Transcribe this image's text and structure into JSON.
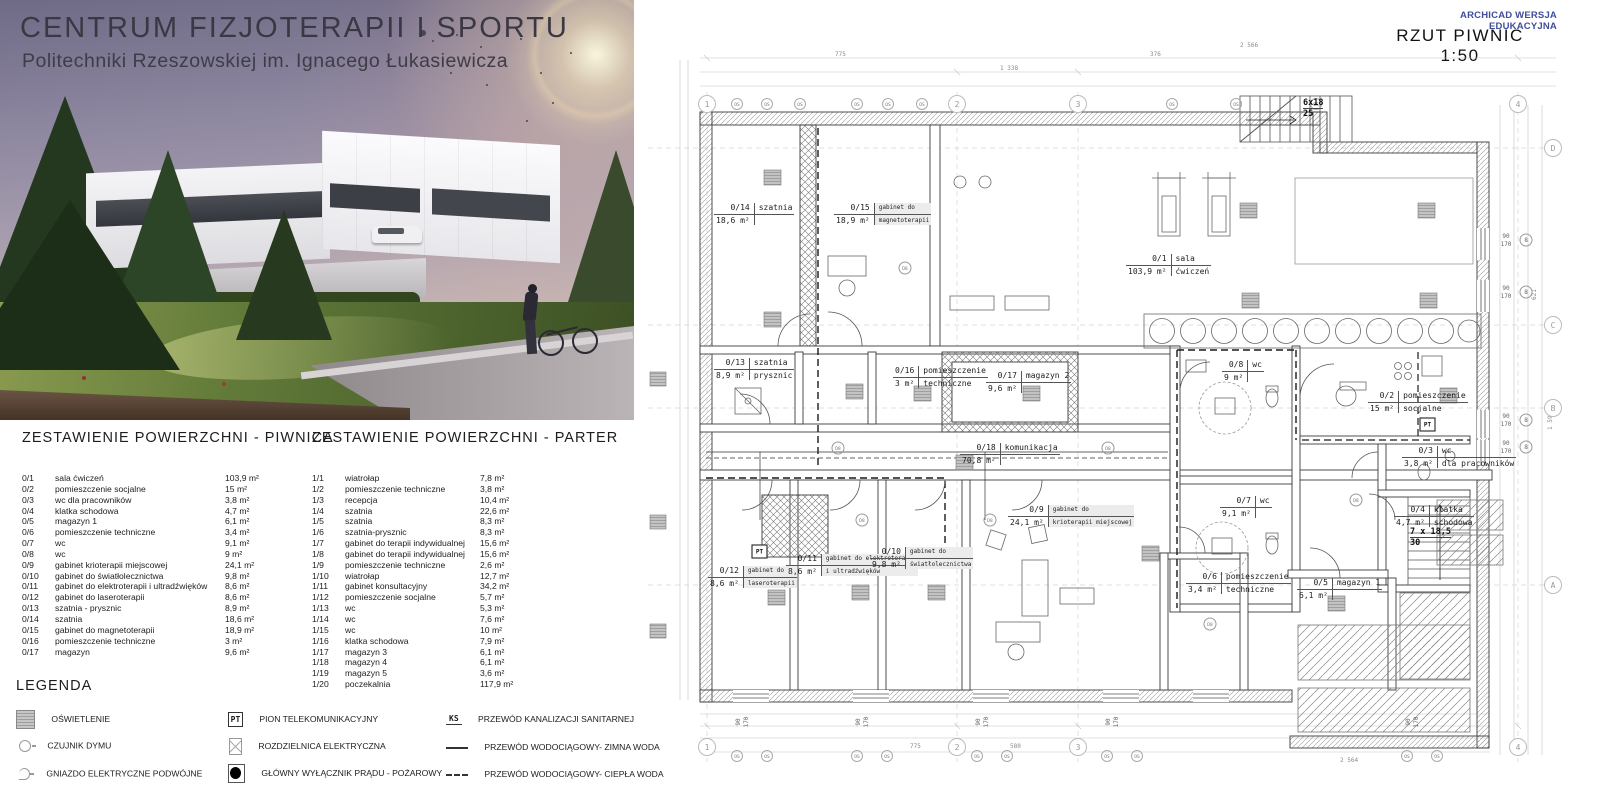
{
  "hero": {
    "title": "CENTRUM  FIZJOTERAPII I SPORTU",
    "subtitle": "Politechniki Rzeszowskiej im. Ignacego Łukasiewicza"
  },
  "plan_header": {
    "watermark": "ARCHICAD WERSJA EDUKACYJNA",
    "title": "RZUT PIWNIC 1:50"
  },
  "tables": [
    {
      "title": "ZESTAWIENIE POWIERZCHNI - PIWNICA",
      "rows": [
        {
          "id": "0/1",
          "name": "sala ćwiczeń",
          "area": "103,9 m²"
        },
        {
          "id": "0/2",
          "name": "pomieszczenie socjalne",
          "area": "15 m²"
        },
        {
          "id": "0/3",
          "name": "wc dla pracowników",
          "area": "3,8 m²"
        },
        {
          "id": "0/4",
          "name": "klatka schodowa",
          "area": "4,7 m²"
        },
        {
          "id": "0/5",
          "name": "magazyn 1",
          "area": "6,1 m²"
        },
        {
          "id": "0/6",
          "name": "pomieszczenie techniczne",
          "area": "3,4 m²"
        },
        {
          "id": "0/7",
          "name": "wc",
          "area": "9,1 m²"
        },
        {
          "id": "0/8",
          "name": "wc",
          "area": "9 m²"
        },
        {
          "id": "0/9",
          "name": "gabinet krioterapii miejscowej",
          "area": "24,1 m²"
        },
        {
          "id": "0/10",
          "name": "gabinet do światłolecznictwa",
          "area": "9,8 m²"
        },
        {
          "id": "0/11",
          "name": "gabinet do elektroterapii i ultradźwięków",
          "area": "8,6 m²"
        },
        {
          "id": "0/12",
          "name": "gabinet do laseroterapii",
          "area": "8,6 m²"
        },
        {
          "id": "0/13",
          "name": "szatnia - prysznic",
          "area": "8,9 m²"
        },
        {
          "id": "0/14",
          "name": "szatnia",
          "area": "18,6 m²"
        },
        {
          "id": "0/15",
          "name": "gabinet do magnetoterapii",
          "area": "18,9 m²"
        },
        {
          "id": "0/16",
          "name": "pomieszczenie techniczne",
          "area": "3 m²"
        },
        {
          "id": "0/17",
          "name": "magazyn",
          "area": "9,6 m²"
        }
      ]
    },
    {
      "title": "ZESTAWIENIE POWIERZCHNI - PARTER",
      "rows": [
        {
          "id": "1/1",
          "name": "wiatrołap",
          "area": "7,8 m²"
        },
        {
          "id": "1/2",
          "name": "pomieszczenie techniczne",
          "area": "3,8 m²"
        },
        {
          "id": "1/3",
          "name": "recepcja",
          "area": "10,4 m²"
        },
        {
          "id": "1/4",
          "name": "szatnia",
          "area": "22,6 m²"
        },
        {
          "id": "1/5",
          "name": "szatnia",
          "area": "8,3 m²"
        },
        {
          "id": "1/6",
          "name": "szatnia-prysznic",
          "area": "8,3 m²"
        },
        {
          "id": "1/7",
          "name": "gabinet do terapii indywidualnej",
          "area": "15,6 m²"
        },
        {
          "id": "1/8",
          "name": "gabinet do terapii indywidualnej",
          "area": "15,6 m²"
        },
        {
          "id": "1/9",
          "name": "pomieszczenie techniczne",
          "area": "2,6 m²"
        },
        {
          "id": "1/10",
          "name": "wiatrołap",
          "area": "12,7 m²"
        },
        {
          "id": "1/11",
          "name": "gabinet konsultacyjny",
          "area": "34,2 m²"
        },
        {
          "id": "1/12",
          "name": "pomieszczenie socjalne",
          "area": "5,7 m²"
        },
        {
          "id": "1/13",
          "name": "wc",
          "area": "5,3 m²"
        },
        {
          "id": "1/14",
          "name": "wc",
          "area": "7,6 m²"
        },
        {
          "id": "1/15",
          "name": "wc",
          "area": "10 m²"
        },
        {
          "id": "1/16",
          "name": "klatka schodowa",
          "area": "7,9 m²"
        },
        {
          "id": "1/17",
          "name": "magazyn 3",
          "area": "6,1 m²"
        },
        {
          "id": "1/18",
          "name": "magazyn 4",
          "area": "6,1 m²"
        },
        {
          "id": "1/19",
          "name": "magazyn 5",
          "area": "3,6 m²"
        },
        {
          "id": "1/20",
          "name": "poczekalnia",
          "area": "117,9 m²"
        }
      ]
    }
  ],
  "legend": {
    "title": "LEGENDA",
    "col1": [
      {
        "label": "OŚWIETLENIE"
      },
      {
        "label": "CZUJNIK DYMU"
      },
      {
        "label": "GNIAZDO ELEKTRYCZNE PODWÓJNE"
      }
    ],
    "col2": [
      {
        "icon_text": "PT",
        "label": "PION TELEKOMUNIKACYJNY"
      },
      {
        "label": "ROZDZIELNICA ELEKTRYCZNA"
      },
      {
        "label": "GŁÓWNY WYŁĄCZNIK PRĄDU - POŻAROWY"
      }
    ],
    "col3": [
      {
        "icon_text": "KS",
        "label": "PRZEWÓD KANALIZACJI SANITARNEJ"
      },
      {
        "label": "PRZEWÓD WODOCIĄGOWY- ZIMNA WODA"
      },
      {
        "label": "PRZEWÓD WODOCIĄGOWY- CIEPŁA WODA"
      }
    ]
  },
  "plan": {
    "rooms": [
      {
        "id": "0/14",
        "area": "18,6 m²",
        "name": "szatnia",
        "name2": ""
      },
      {
        "id": "0/15",
        "area": "18,9 m²",
        "name": "gabinet do",
        "name2": "magnetoterapii"
      },
      {
        "id": "0/1",
        "area": "103,9 m²",
        "name": "sala",
        "name2": "ćwiczeń"
      },
      {
        "id": "0/13",
        "area": "8,9 m²",
        "name": "szatnia",
        "name2": "prysznic"
      },
      {
        "id": "0/16",
        "area": "3 m²",
        "name": "pomieszczenie",
        "name2": "techniczne"
      },
      {
        "id": "0/17",
        "area": "9,6 m²",
        "name": "magazyn 2",
        "name2": ""
      },
      {
        "id": "0/18",
        "area": "70,8 m²",
        "name": "komunikacja",
        "name2": ""
      },
      {
        "id": "0/8",
        "area": "9 m²",
        "name": "wc",
        "name2": ""
      },
      {
        "id": "0/2",
        "area": "15 m²",
        "name": "pomieszczenie",
        "name2": "socjalne"
      },
      {
        "id": "0/7",
        "area": "9,1 m²",
        "name": "wc",
        "name2": ""
      },
      {
        "id": "0/3",
        "area": "3,8 m²",
        "name": "wc",
        "name2": "dla pracowników"
      },
      {
        "id": "0/9",
        "area": "24,1 m²",
        "name": "gabinet do",
        "name2": "krioterapii miejscowej"
      },
      {
        "id": "0/12",
        "area": "8,6 m²",
        "name": "gabinet do",
        "name2": "laseroterapii"
      },
      {
        "id": "0/11",
        "area": "8,6 m²",
        "name": "gabinet do elektroterapii",
        "name2": "i ultradźwięków"
      },
      {
        "id": "0/10",
        "area": "9,8 m²",
        "name": "gabinet do",
        "name2": "światłolecznictwa"
      },
      {
        "id": "0/6",
        "area": "3,4 m²",
        "name": "pomieszczenie",
        "name2": "techniczne"
      },
      {
        "id": "0/5",
        "area": "6,1 m²",
        "name": "magazyn 1",
        "name2": ""
      },
      {
        "id": "0/4",
        "area": "4,7 m²",
        "name": "klatka",
        "name2": "schodowa"
      }
    ],
    "stairs": {
      "down_run": "7 x 18,5",
      "down_count": "30",
      "up_run": "6x18",
      "up_count": "25"
    },
    "grid": {
      "cols": [
        "1",
        "2",
        "3",
        "4"
      ],
      "rows": [
        "D",
        "C",
        "B",
        "A"
      ]
    },
    "symbols": {
      "os": "OS",
      "d8": "D8",
      "pt": "PT",
      "win_w": "90",
      "win_h": "170",
      "window_mark": "8"
    },
    "dims": {
      "top": [
        "775",
        "1 338",
        "376",
        "2 566"
      ],
      "bottom": [
        "775",
        "580",
        "2 564"
      ],
      "right": [
        "621",
        "1 594"
      ]
    }
  }
}
